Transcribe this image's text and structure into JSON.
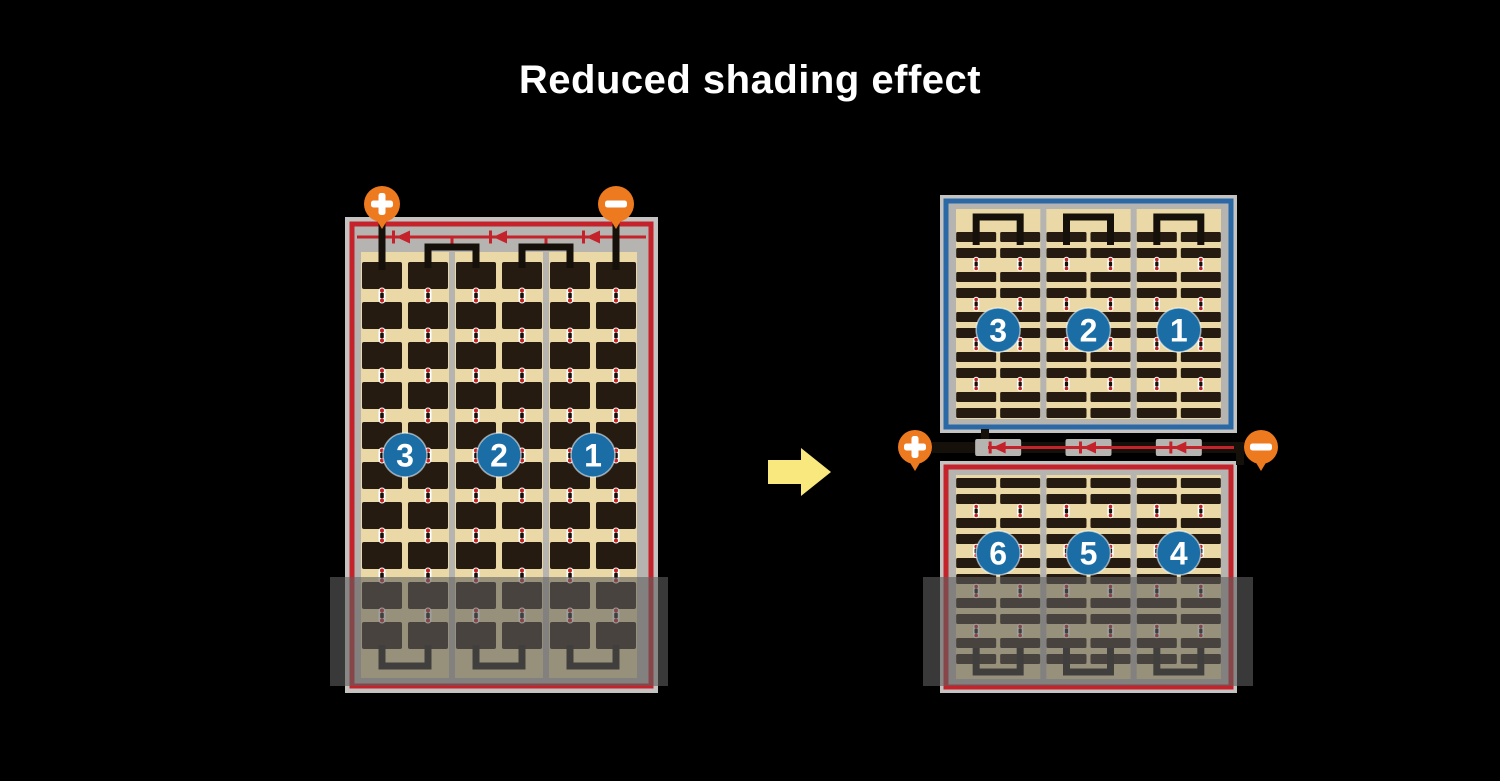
{
  "title": "Reduced shading effect",
  "colors": {
    "background": "#000000",
    "title_text": "#ffffff",
    "frame_gray": "#c4c3c1",
    "wiring_gray": "#b6b4b1",
    "panel_tan": "#ead9a6",
    "cell_dark": "#261b11",
    "border_red": "#c4232b",
    "border_blue": "#2b68a6",
    "wire_black": "#16100b",
    "terminal_orange": "#ee7a1f",
    "badge_blue": "#1a6da5",
    "badge_text": "#ffffff",
    "arrow_yellow": "#f8e87e",
    "shade_overlay": "rgba(95,95,95,0.6)",
    "solder_red": "#c32222",
    "solder_white": "#ffffff"
  },
  "left_module": {
    "label": "standard full-cell module",
    "terminals": {
      "positive": "+",
      "negative": "−"
    },
    "string_badges": [
      "3",
      "2",
      "1"
    ]
  },
  "right_module": {
    "label": "split half-cell module",
    "terminals": {
      "positive": "+",
      "negative": "−"
    },
    "top_string_badges": [
      "3",
      "2",
      "1"
    ],
    "bottom_string_badges": [
      "6",
      "5",
      "4"
    ]
  },
  "arrow": {
    "direction": "right"
  }
}
